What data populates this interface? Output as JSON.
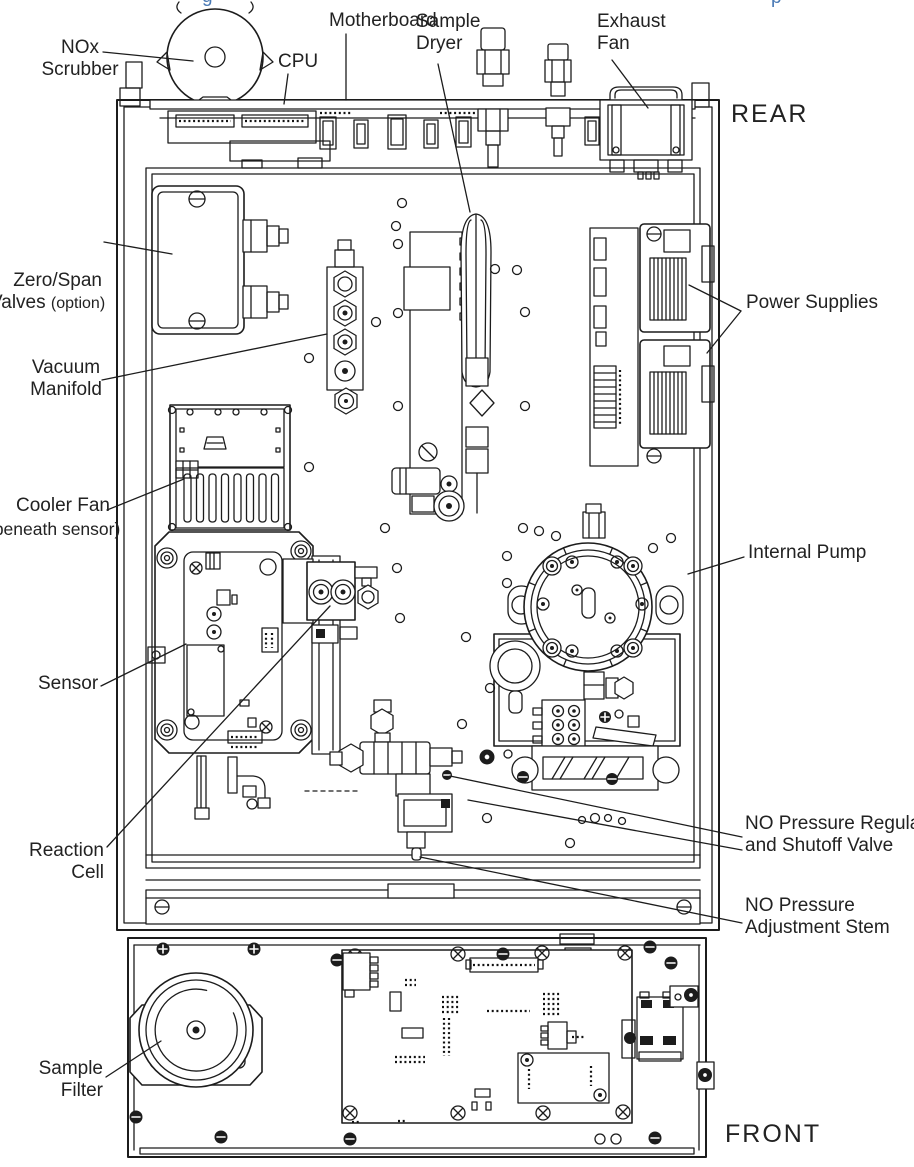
{
  "figure": {
    "type": "instrument internal layout diagram, top view",
    "orientation": {
      "rear": "REAR",
      "front": "FRONT"
    },
    "artifacts": {
      "top_left_fragment": "g",
      "top_right_fragment": "p"
    },
    "labels": {
      "nox_scrubber": "NOx\nScrubber",
      "cpu": "CPU",
      "motherboard": "Motherboard",
      "sample_dryer": "Sample\nDryer",
      "exhaust_fan": "Exhaust\nFan",
      "zero_span_line1": "Zero/Span",
      "zero_span_line2": "Valves ",
      "zero_span_line2_suffix": "(option)",
      "vacuum_manifold": "Vacuum\nManifold",
      "cooler_fan_line1": "Cooler Fan",
      "cooler_fan_line2": "(beneath sensor)",
      "sensor": "Sensor",
      "reaction_cell": "Reaction\nCell",
      "power_supplies": "Power Supplies",
      "internal_pump": "Internal Pump",
      "no_pressure_regulator": "NO Pressure Regulator\nand Shutoff Valve",
      "no_pressure_adjustment": "NO Pressure\nAdjustment Stem",
      "sample_filter": "Sample\nFilter"
    },
    "colors": {
      "line": "#1c1c1c",
      "text": "#222222",
      "background": "#ffffff",
      "fragment": "#4a7ab5"
    }
  }
}
